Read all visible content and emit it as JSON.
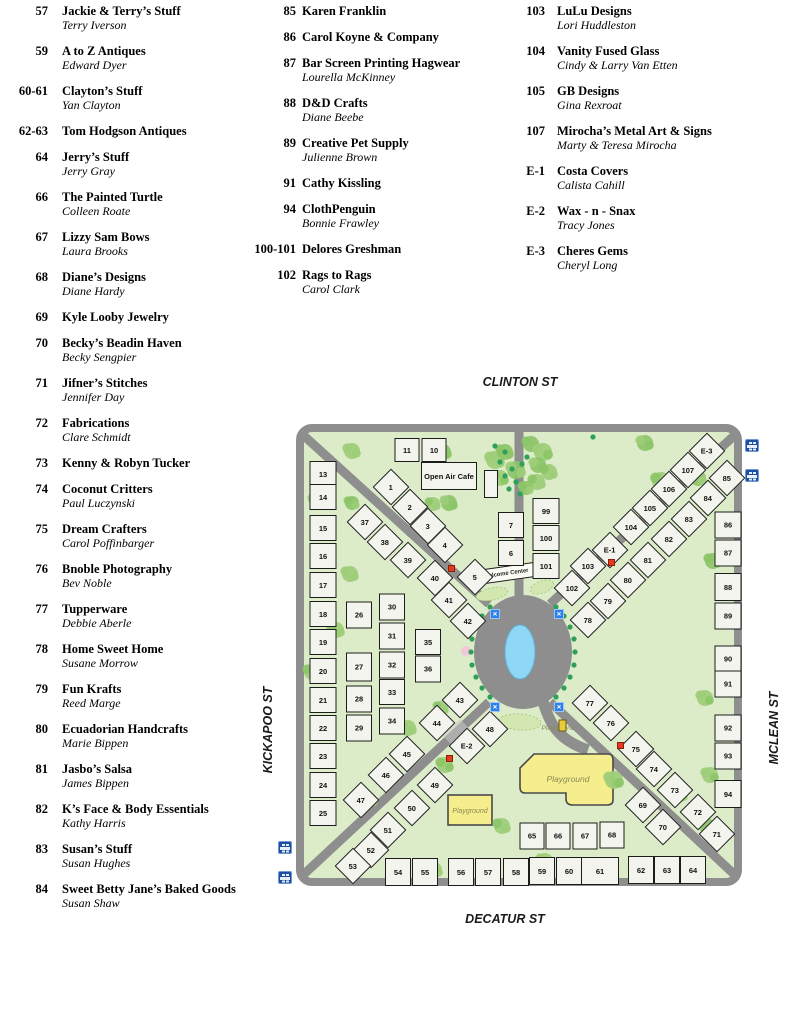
{
  "directory": {
    "columns": [
      {
        "entries": [
          {
            "booth": "57",
            "name": "Jackie & Terry’s Stuff",
            "owner": "Terry Iverson"
          },
          {
            "booth": "59",
            "name": "A to Z Antiques",
            "owner": "Edward Dyer"
          },
          {
            "booth": "60-61",
            "name": "Clayton’s Stuff",
            "owner": "Yan Clayton"
          },
          {
            "booth": "62-63",
            "name": "Tom Hodgson Antiques",
            "owner": ""
          },
          {
            "booth": "64",
            "name": "Jerry’s Stuff",
            "owner": "Jerry Gray"
          },
          {
            "booth": "66",
            "name": "The Painted Turtle",
            "owner": "Colleen Roate"
          },
          {
            "booth": "67",
            "name": "Lizzy Sam Bows",
            "owner": "Laura Brooks"
          },
          {
            "booth": "68",
            "name": "Diane’s Designs",
            "owner": "Diane Hardy"
          },
          {
            "booth": "69",
            "name": "Kyle Looby Jewelry",
            "owner": ""
          },
          {
            "booth": "70",
            "name": "Becky’s Beadin Haven",
            "owner": "Becky Sengpier"
          },
          {
            "booth": "71",
            "name": "Jifner’s Stitches",
            "owner": "Jennifer Day"
          },
          {
            "booth": "72",
            "name": "Fabrications",
            "owner": "Clare Schmidt"
          },
          {
            "booth": "73",
            "name": "Kenny & Robyn Tucker",
            "owner": ""
          },
          {
            "booth": "74",
            "name": "Coconut Critters",
            "owner": "Paul Luczynski"
          },
          {
            "booth": "75",
            "name": "Dream Crafters",
            "owner": "Carol Poffinbarger"
          },
          {
            "booth": "76",
            "name": "Bnoble Photography",
            "owner": "Bev Noble"
          },
          {
            "booth": "77",
            "name": "Tupperware",
            "owner": "Debbie Aberle"
          },
          {
            "booth": "78",
            "name": "Home Sweet Home",
            "owner": "Susane Morrow"
          },
          {
            "booth": "79",
            "name": "Fun Krafts",
            "owner": "Reed Marge"
          },
          {
            "booth": "80",
            "name": "Ecuadorian Handcrafts",
            "owner": "Marie Bippen"
          },
          {
            "booth": "81",
            "name": "Jasbo’s Salsa",
            "owner": "James Bippen"
          },
          {
            "booth": "82",
            "name": "K’s Face & Body Essentials",
            "owner": "Kathy Harris"
          },
          {
            "booth": "83",
            "name": "Susan’s Stuff",
            "owner": "Susan Hughes"
          },
          {
            "booth": "84",
            "name": "Sweet  Betty Jane’s Baked Goods",
            "owner": "Susan Shaw"
          }
        ]
      },
      {
        "entries": [
          {
            "booth": "85",
            "name": "Karen Franklin",
            "owner": ""
          },
          {
            "booth": "86",
            "name": "Carol Koyne & Company",
            "owner": ""
          },
          {
            "booth": "87",
            "name": "Bar Screen Printing Hagwear",
            "owner": "Lourella McKinney"
          },
          {
            "booth": "88",
            "name": "D&D Crafts",
            "owner": "Diane Beebe"
          },
          {
            "booth": "89",
            "name": "Creative Pet Supply",
            "owner": "Julienne Brown"
          },
          {
            "booth": "91",
            "name": "Cathy Kissling",
            "owner": ""
          },
          {
            "booth": "94",
            "name": "ClothPenguin",
            "owner": "Bonnie Frawley"
          },
          {
            "booth": "100-101",
            "name": "Delores Greshman",
            "owner": ""
          },
          {
            "booth": "102",
            "name": "Rags to Rags",
            "owner": "Carol Clark"
          }
        ]
      },
      {
        "entries": [
          {
            "booth": "103",
            "name": "LuLu Designs",
            "owner": "Lori Huddleston"
          },
          {
            "booth": "104",
            "name": "Vanity Fused Glass",
            "owner": "Cindy & Larry Van Etten"
          },
          {
            "booth": "105",
            "name": "GB Designs",
            "owner": "Gina Rexroat"
          },
          {
            "booth": "107",
            "name": "Mirocha’s Metal Art & Signs",
            "owner": "Marty & Teresa Mirocha"
          },
          {
            "booth": "E-1",
            "name": "Costa Covers",
            "owner": "Calista Cahill"
          },
          {
            "booth": "E-2",
            "name": "Wax - n - Snax",
            "owner": "Tracy Jones"
          },
          {
            "booth": "E-3",
            "name": "Cheres Gems",
            "owner": "Cheryl Long"
          }
        ]
      }
    ]
  },
  "map": {
    "streets": {
      "top": "CLINTON ST",
      "bottom": "DECATUR ST",
      "left": "KICKAPOO ST",
      "right": "MCLEAN ST"
    },
    "labels": {
      "open_air_cafe": "Open Air Cafe",
      "welcome_center": "Welcome Center",
      "playground": "Playground"
    },
    "colors": {
      "park_green": "#dcebc8",
      "road_gray": "#8e8e8e",
      "booth_fill": "#f3f4ed",
      "pond_blue": "#8ed7f5",
      "playground_yellow": "#f6ee8d",
      "tree_green": "#9dcd78",
      "dot_green": "#2ea05a",
      "marker_blue": "#2f80e8",
      "marker_red": "#e23b1e",
      "parking_blue": "#1c4fa1"
    },
    "booths": [
      [
        "1",
        87,
        55,
        26,
        26,
        45
      ],
      [
        "2",
        106,
        75,
        26,
        26,
        45
      ],
      [
        "3",
        124,
        94,
        26,
        26,
        45
      ],
      [
        "4",
        141,
        113,
        26,
        26,
        45
      ],
      [
        "5",
        171,
        145,
        26,
        26,
        45
      ],
      [
        "37",
        61,
        90,
        26,
        26,
        45
      ],
      [
        "38",
        81,
        110,
        26,
        26,
        45
      ],
      [
        "39",
        104,
        128,
        26,
        26,
        45
      ],
      [
        "40",
        131,
        146,
        26,
        26,
        45
      ],
      [
        "41",
        145,
        168,
        26,
        26,
        45
      ],
      [
        "42",
        164,
        189,
        26,
        26,
        45
      ],
      [
        "E-3",
        403,
        19,
        26,
        26,
        45
      ],
      [
        "107",
        384,
        38,
        26,
        26,
        45
      ],
      [
        "106",
        365,
        57,
        26,
        26,
        45
      ],
      [
        "105",
        346,
        76,
        26,
        26,
        45
      ],
      [
        "104",
        327,
        95,
        26,
        26,
        45
      ],
      [
        "E-1",
        306,
        118,
        26,
        26,
        45
      ],
      [
        "103",
        284,
        134,
        26,
        26,
        45
      ],
      [
        "102",
        268,
        156,
        26,
        26,
        45
      ],
      [
        "85",
        423,
        46,
        26,
        26,
        45
      ],
      [
        "84",
        404,
        66,
        26,
        26,
        45
      ],
      [
        "83",
        385,
        87,
        26,
        26,
        45
      ],
      [
        "82",
        365,
        107,
        26,
        26,
        45
      ],
      [
        "81",
        344,
        128,
        26,
        26,
        45
      ],
      [
        "80",
        324,
        148,
        26,
        26,
        45
      ],
      [
        "79",
        304,
        169,
        26,
        26,
        45
      ],
      [
        "78",
        284,
        188,
        26,
        26,
        45
      ],
      [
        "77",
        286,
        271,
        26,
        26,
        45
      ],
      [
        "76",
        307,
        291,
        26,
        26,
        45
      ],
      [
        "75",
        332,
        317,
        26,
        26,
        45
      ],
      [
        "74",
        350,
        337,
        26,
        26,
        45
      ],
      [
        "73",
        371,
        358,
        26,
        26,
        45
      ],
      [
        "72",
        394,
        380,
        26,
        26,
        45
      ],
      [
        "71",
        413,
        402,
        26,
        26,
        45
      ],
      [
        "69",
        339,
        373,
        26,
        26,
        45
      ],
      [
        "70",
        359,
        395,
        26,
        26,
        45
      ],
      [
        "43",
        156,
        268,
        26,
        26,
        45
      ],
      [
        "44",
        133,
        291,
        26,
        26,
        45
      ],
      [
        "45",
        103,
        322,
        26,
        26,
        45
      ],
      [
        "46",
        82,
        343,
        26,
        26,
        45
      ],
      [
        "47",
        57,
        368,
        26,
        26,
        45
      ],
      [
        "48",
        186,
        297,
        26,
        26,
        45
      ],
      [
        "E-2",
        163,
        314,
        26,
        26,
        45
      ],
      [
        "49",
        131,
        353,
        26,
        26,
        45
      ],
      [
        "50",
        108,
        376,
        26,
        26,
        45
      ],
      [
        "51",
        84,
        398,
        26,
        26,
        45
      ],
      [
        "52",
        67,
        418,
        26,
        26,
        45
      ],
      [
        "53",
        49,
        434,
        26,
        26,
        45
      ],
      [
        "11",
        103,
        18,
        25,
        24,
        0
      ],
      [
        "10",
        130,
        18,
        25,
        24,
        0
      ],
      [
        "",
        187,
        52,
        14,
        28,
        0
      ],
      [
        "13",
        19,
        42,
        27,
        26,
        0
      ],
      [
        "14",
        19,
        65,
        27,
        26,
        0
      ],
      [
        "15",
        19,
        96,
        27,
        26,
        0
      ],
      [
        "16",
        19,
        124,
        27,
        26,
        0
      ],
      [
        "17",
        19,
        153,
        27,
        26,
        0
      ],
      [
        "18",
        19,
        182,
        27,
        26,
        0
      ],
      [
        "19",
        19,
        210,
        27,
        26,
        0
      ],
      [
        "20",
        19,
        239,
        27,
        26,
        0
      ],
      [
        "21",
        19,
        268,
        27,
        26,
        0
      ],
      [
        "22",
        19,
        296,
        27,
        26,
        0
      ],
      [
        "23",
        19,
        324,
        27,
        26,
        0
      ],
      [
        "24",
        19,
        353,
        27,
        26,
        0
      ],
      [
        "25",
        19,
        381,
        27,
        26,
        0
      ],
      [
        "26",
        55,
        183,
        26,
        27,
        0
      ],
      [
        "27",
        55,
        235,
        26,
        29,
        0
      ],
      [
        "28",
        55,
        267,
        26,
        27,
        0
      ],
      [
        "29",
        55,
        296,
        26,
        27,
        0
      ],
      [
        "30",
        88,
        175,
        26,
        27,
        0
      ],
      [
        "31",
        88,
        204,
        26,
        27,
        0
      ],
      [
        "32",
        88,
        233,
        26,
        27,
        0
      ],
      [
        "33",
        88,
        260,
        26,
        26,
        0
      ],
      [
        "34",
        88,
        289,
        26,
        27,
        0
      ],
      [
        "35",
        124,
        210,
        26,
        26,
        0
      ],
      [
        "36",
        124,
        237,
        26,
        27,
        0
      ],
      [
        "7",
        207,
        93,
        26,
        26,
        0
      ],
      [
        "6",
        207,
        121,
        26,
        26,
        0
      ],
      [
        "99",
        242,
        79,
        27,
        26,
        0
      ],
      [
        "100",
        242,
        106,
        27,
        26,
        0
      ],
      [
        "101",
        242,
        134,
        27,
        26,
        0
      ],
      [
        "86",
        424,
        93,
        27,
        27,
        0
      ],
      [
        "87",
        424,
        121,
        27,
        27,
        0
      ],
      [
        "88",
        424,
        155,
        27,
        28,
        0
      ],
      [
        "89",
        424,
        184,
        27,
        27,
        0
      ],
      [
        "90",
        424,
        227,
        27,
        27,
        0
      ],
      [
        "91",
        424,
        252,
        27,
        27,
        0
      ],
      [
        "92",
        424,
        296,
        27,
        27,
        0
      ],
      [
        "93",
        424,
        324,
        27,
        27,
        0
      ],
      [
        "94",
        424,
        362,
        27,
        28,
        0
      ],
      [
        "65",
        228,
        404,
        25,
        27,
        0
      ],
      [
        "66",
        254,
        404,
        25,
        27,
        0
      ],
      [
        "67",
        281,
        404,
        25,
        27,
        0
      ],
      [
        "68",
        308,
        403,
        25,
        27,
        0
      ],
      [
        "54",
        94,
        440,
        26,
        28,
        0
      ],
      [
        "55",
        121,
        440,
        26,
        28,
        0
      ],
      [
        "56",
        157,
        440,
        26,
        28,
        0
      ],
      [
        "57",
        184,
        440,
        26,
        28,
        0
      ],
      [
        "58",
        212,
        440,
        26,
        28,
        0
      ],
      [
        "59",
        238,
        439,
        26,
        28,
        0
      ],
      [
        "60",
        265,
        439,
        26,
        28,
        0
      ],
      [
        "61",
        296,
        439,
        38,
        28,
        0
      ],
      [
        "62",
        337,
        438,
        26,
        28,
        0
      ],
      [
        "63",
        363,
        438,
        26,
        28,
        0
      ],
      [
        "64",
        389,
        438,
        26,
        28,
        0
      ]
    ],
    "markers": {
      "blue": [
        [
          191,
          182
        ],
        [
          255,
          182
        ],
        [
          191,
          275
        ],
        [
          255,
          275
        ]
      ],
      "red": [
        [
          147,
          136
        ],
        [
          307,
          130
        ],
        [
          145,
          326
        ],
        [
          316,
          313
        ]
      ],
      "parking": [
        [
          745,
          69
        ],
        [
          745,
          99
        ],
        [
          278,
          471
        ],
        [
          278,
          501
        ]
      ]
    },
    "trees": [
      [
        56,
        27,
        8
      ],
      [
        147,
        28,
        8
      ],
      [
        153,
        79,
        8
      ],
      [
        21,
        77,
        8
      ],
      [
        56,
        79,
        7
      ],
      [
        54,
        150,
        8
      ],
      [
        137,
        80,
        7
      ],
      [
        199,
        36,
        9
      ],
      [
        209,
        28,
        8
      ],
      [
        220,
        46,
        9
      ],
      [
        204,
        54,
        8
      ],
      [
        235,
        20,
        8
      ],
      [
        247,
        28,
        9
      ],
      [
        242,
        41,
        8
      ],
      [
        253,
        48,
        8
      ],
      [
        241,
        58,
        8
      ],
      [
        230,
        64,
        7
      ],
      [
        349,
        19,
        8
      ],
      [
        365,
        57,
        9
      ],
      [
        402,
        54,
        8
      ],
      [
        417,
        137,
        8
      ],
      [
        40,
        206,
        8
      ],
      [
        16,
        248,
        8
      ],
      [
        112,
        304,
        8
      ],
      [
        145,
        284,
        7
      ],
      [
        149,
        341,
        8
      ],
      [
        26,
        363,
        8
      ],
      [
        74,
        376,
        7
      ],
      [
        138,
        446,
        8
      ],
      [
        249,
        437,
        8
      ],
      [
        312,
        450,
        8
      ],
      [
        206,
        402,
        8
      ],
      [
        318,
        356,
        9
      ],
      [
        384,
        371,
        7
      ],
      [
        409,
        274,
        8
      ],
      [
        414,
        351,
        8
      ],
      [
        411,
        402,
        8
      ]
    ],
    "dots": [
      [
        194,
        273
      ],
      [
        186,
        264
      ],
      [
        180,
        253
      ],
      [
        176,
        241
      ],
      [
        175,
        228
      ],
      [
        176,
        215
      ],
      [
        180,
        203
      ],
      [
        186,
        192
      ],
      [
        194,
        183
      ],
      [
        260,
        183
      ],
      [
        268,
        192
      ],
      [
        274,
        203
      ],
      [
        278,
        215
      ],
      [
        279,
        228
      ],
      [
        278,
        241
      ],
      [
        274,
        253
      ],
      [
        268,
        264
      ],
      [
        260,
        273
      ],
      [
        199,
        22
      ],
      [
        209,
        28
      ],
      [
        204,
        38
      ],
      [
        216,
        45
      ],
      [
        209,
        52
      ],
      [
        220,
        58
      ],
      [
        213,
        65
      ],
      [
        224,
        70
      ],
      [
        231,
        33
      ],
      [
        226,
        40
      ],
      [
        297,
        13
      ]
    ]
  }
}
